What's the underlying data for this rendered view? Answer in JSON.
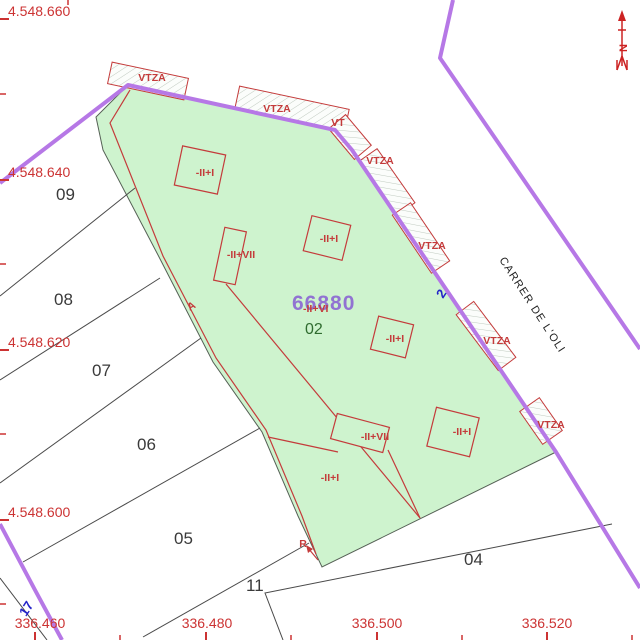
{
  "axes": {
    "y": [
      "4.548.660",
      "4.548.640",
      "4.548.620",
      "4.548.600"
    ],
    "x": [
      "336.460",
      "336.480",
      "336.500",
      "336.520"
    ]
  },
  "north": {
    "label": "N"
  },
  "street": {
    "name": "CARRER DE L'OLI",
    "number_front": "2",
    "number_side": "17"
  },
  "parcel": {
    "reference": "66880",
    "subparcel_code": "02",
    "subparcel_letter_a": "A",
    "subparcel_letter_r": "R"
  },
  "neighbors": [
    "09",
    "08",
    "07",
    "06",
    "05",
    "11",
    "04"
  ],
  "porches": {
    "p1": "VTZA",
    "p2": "VTZA",
    "p3": "VT",
    "p4": "VTZA",
    "p5": "VTZA",
    "p6": "VTZA",
    "p7": "VTZA"
  },
  "floors": {
    "f1": "-II+I",
    "f2": "-II+VII",
    "f3": "-II+I",
    "f4": "-II+VI",
    "f5": "-II+I",
    "f6": "-II+VII",
    "f7": "-II+I",
    "f8": "-II+I"
  },
  "colors": {
    "boundary_purple": "#b678e6",
    "cadastral_red": "#c43b3b",
    "parcel_green": "#cef3ce",
    "reference_purple": "#9173d2",
    "subparcel_green": "#2f6b2f",
    "street_blue": "#2424c8",
    "line_gray": "#4a4a4a"
  }
}
